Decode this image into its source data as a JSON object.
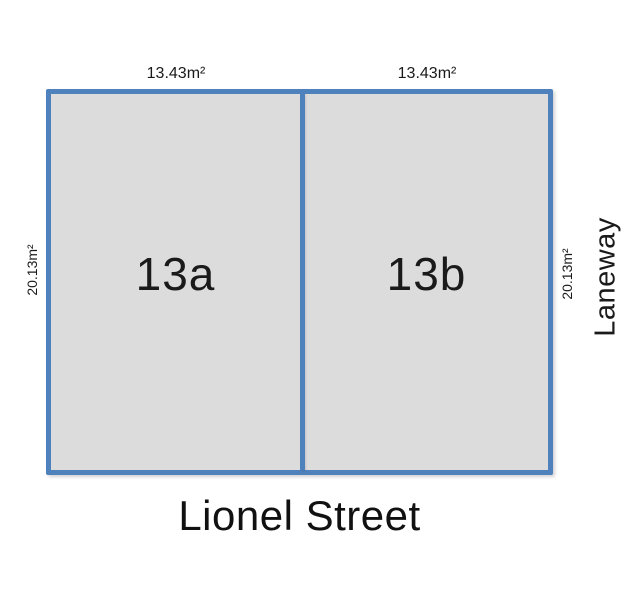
{
  "diagram": {
    "type": "land-subdivision-plan",
    "lots": [
      {
        "name": "13a",
        "frontage_label": "13.43m²",
        "depth_label": "20.13m²"
      },
      {
        "name": "13b",
        "frontage_label": "13.43m²",
        "depth_label": "20.13m²"
      }
    ],
    "streets": {
      "bottom": "Lionel Street",
      "right": "Laneway"
    },
    "colors": {
      "boundary": "#4f81bd",
      "lot_fill": "#dcdcdc",
      "text": "#111111",
      "background": "#ffffff"
    }
  }
}
